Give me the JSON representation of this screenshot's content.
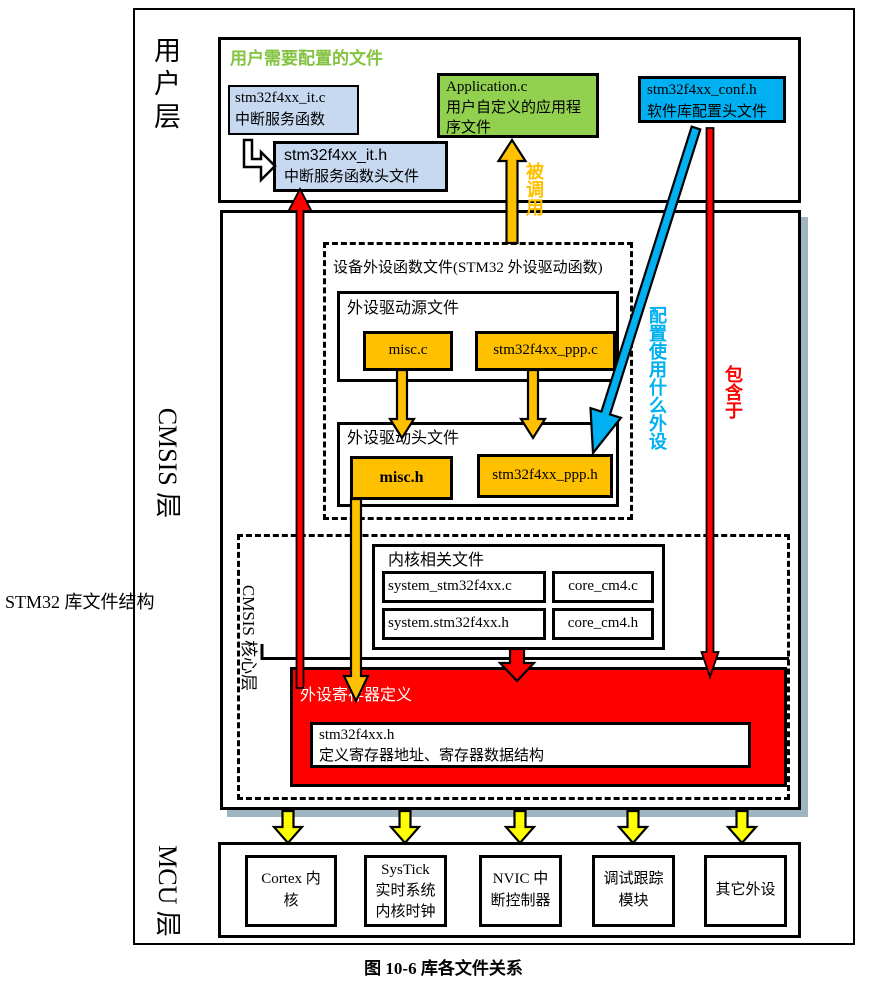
{
  "figure": {
    "side_label": "STM32 库文件结构",
    "caption": "图 10-6 库各文件关系"
  },
  "layers": {
    "user": {
      "label": "用户层",
      "title": "用户需要配置的文件",
      "it_c": {
        "line1": "stm32f4xx_it.c",
        "line2": "中断服务函数"
      },
      "it_h": {
        "line1": "stm32f4xx_it.h",
        "line2": "中断服务函数头文件"
      },
      "app": {
        "line1": "Application.c",
        "line2": "用户自定义的应用程",
        "line3": "序文件"
      },
      "conf": {
        "line1": "stm32f4xx_conf.h",
        "line2": "软件库配置头文件"
      }
    },
    "cmsis": {
      "label": "CMSIS 层",
      "device": {
        "title": "设备外设函数文件(STM32 外设驱动函数)",
        "source": {
          "title": "外设驱动源文件",
          "files": [
            "misc.c",
            "stm32f4xx_ppp.c"
          ]
        },
        "header": {
          "title": "外设驱动头文件",
          "files": [
            "misc.h",
            "stm32f4xx_ppp.h"
          ]
        }
      },
      "core": {
        "label": "CMSIS 核心层",
        "kernel": {
          "title": "内核相关文件",
          "files": [
            "system_stm32f4xx.c",
            "core_cm4.c",
            "system.stm32f4xx.h",
            "core_cm4.h"
          ]
        },
        "register": {
          "title": "外设寄存器定义",
          "file": {
            "line1": "stm32f4xx.h",
            "line2": "定义寄存器地址、寄存器数据结构"
          }
        }
      }
    },
    "mcu": {
      "label": "MCU 层",
      "boxes": [
        {
          "lines": [
            "Cortex 内",
            "核"
          ]
        },
        {
          "lines": [
            "SysTick",
            "实时系统",
            "内核时钟"
          ]
        },
        {
          "lines": [
            "NVIC 中",
            "断控制器"
          ]
        },
        {
          "lines": [
            "调试跟踪",
            "模块"
          ]
        },
        {
          "lines": [
            "其它外设"
          ]
        }
      ]
    }
  },
  "arrows": {
    "called_label": "被调用",
    "config_label": "配置使用什么外设",
    "included_label": "包含于"
  },
  "colors": {
    "light_blue_box": "#C6D9F0",
    "green_box": "#92D050",
    "cyan_box": "#00B0F0",
    "orange_box": "#FFC000",
    "red_box": "#FF0000",
    "yellow_arrow": "#FFFF00",
    "orange_arrow": "#FFC000",
    "red_arrow": "#FF0000",
    "blue_arrow": "#00B0F0",
    "green_title_text": "#84C342",
    "cmsis_shadow": "#9FB6C2"
  }
}
